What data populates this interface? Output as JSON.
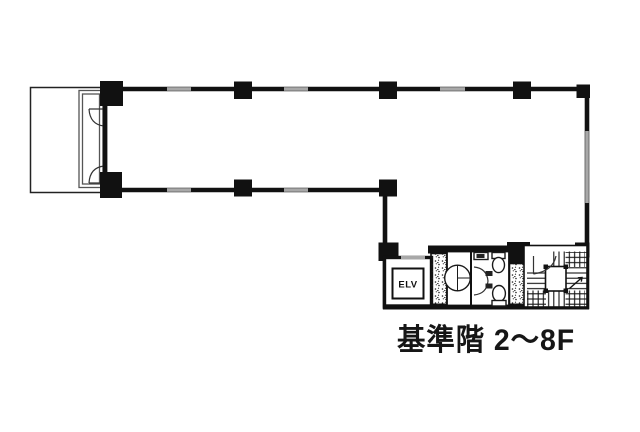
{
  "drawing": {
    "kind": "building-floor-plan",
    "caption": {
      "text": "基準階 2～8F"
    },
    "elevator": {
      "label": "ELV"
    },
    "colors": {
      "ink": "#111111",
      "window_gray": "#a8a8a8",
      "background": "#ffffff"
    }
  }
}
